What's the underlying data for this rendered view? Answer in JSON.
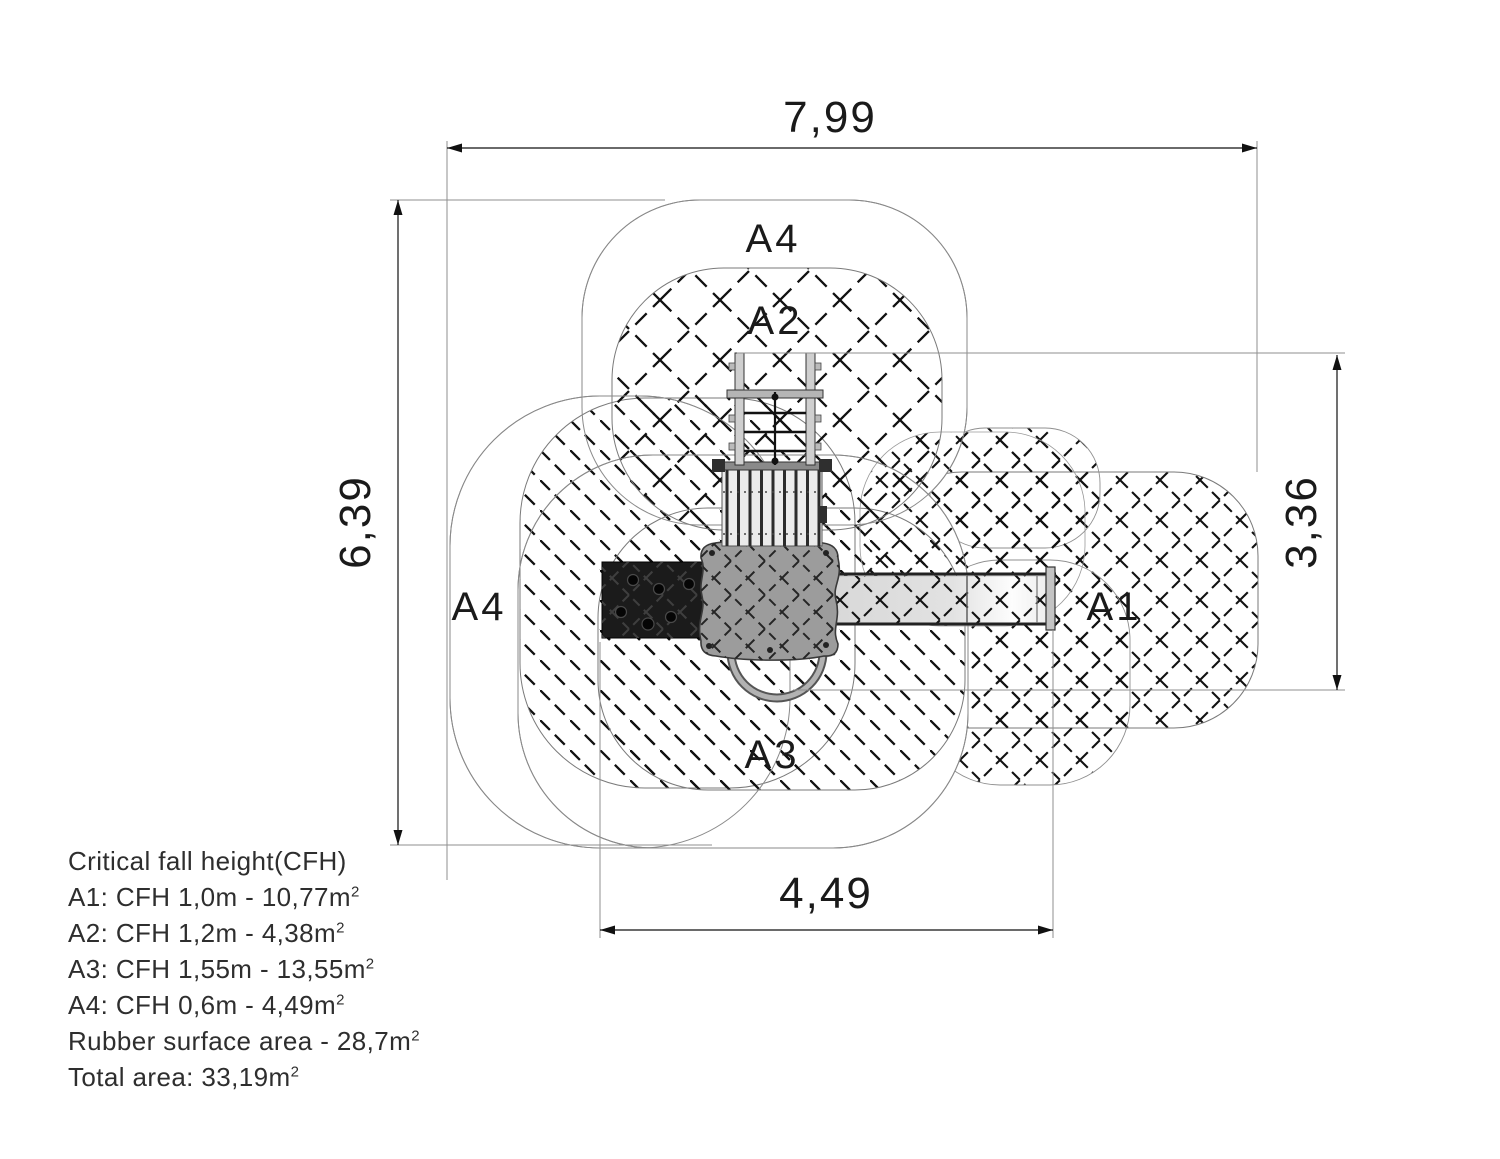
{
  "zones": {
    "a4_top": "A4",
    "a2": "A2",
    "a4_left": "A4",
    "a1": "A1",
    "a3": "A3"
  },
  "dims": {
    "overall_width": "7,99",
    "overall_height": "6,39",
    "equipment_height": "3,36",
    "equipment_width": "4,49"
  },
  "legend": {
    "title": "Critical fall height(CFH)",
    "items": [
      {
        "text": "A1: CFH 1,0m - 10,77m",
        "sup": "2"
      },
      {
        "text": "A2: CFH 1,2m - 4,38m",
        "sup": "2"
      },
      {
        "text": "A3: CFH 1,55m - 13,55m",
        "sup": "2"
      },
      {
        "text": "A4: CFH 0,6m - 4,49m",
        "sup": "2"
      },
      {
        "text": "Rubber surface area - 28,7m",
        "sup": "2"
      },
      {
        "text": "Total area: 33,19m",
        "sup": "2"
      }
    ]
  },
  "colors": {
    "hatch": "#111111",
    "boundary": "#7a7a7a",
    "platform": "#9c9c9c",
    "climbing_wall": "#1b1b1b",
    "slide": "#e0e0e0",
    "palisade": "#ebebeb"
  }
}
